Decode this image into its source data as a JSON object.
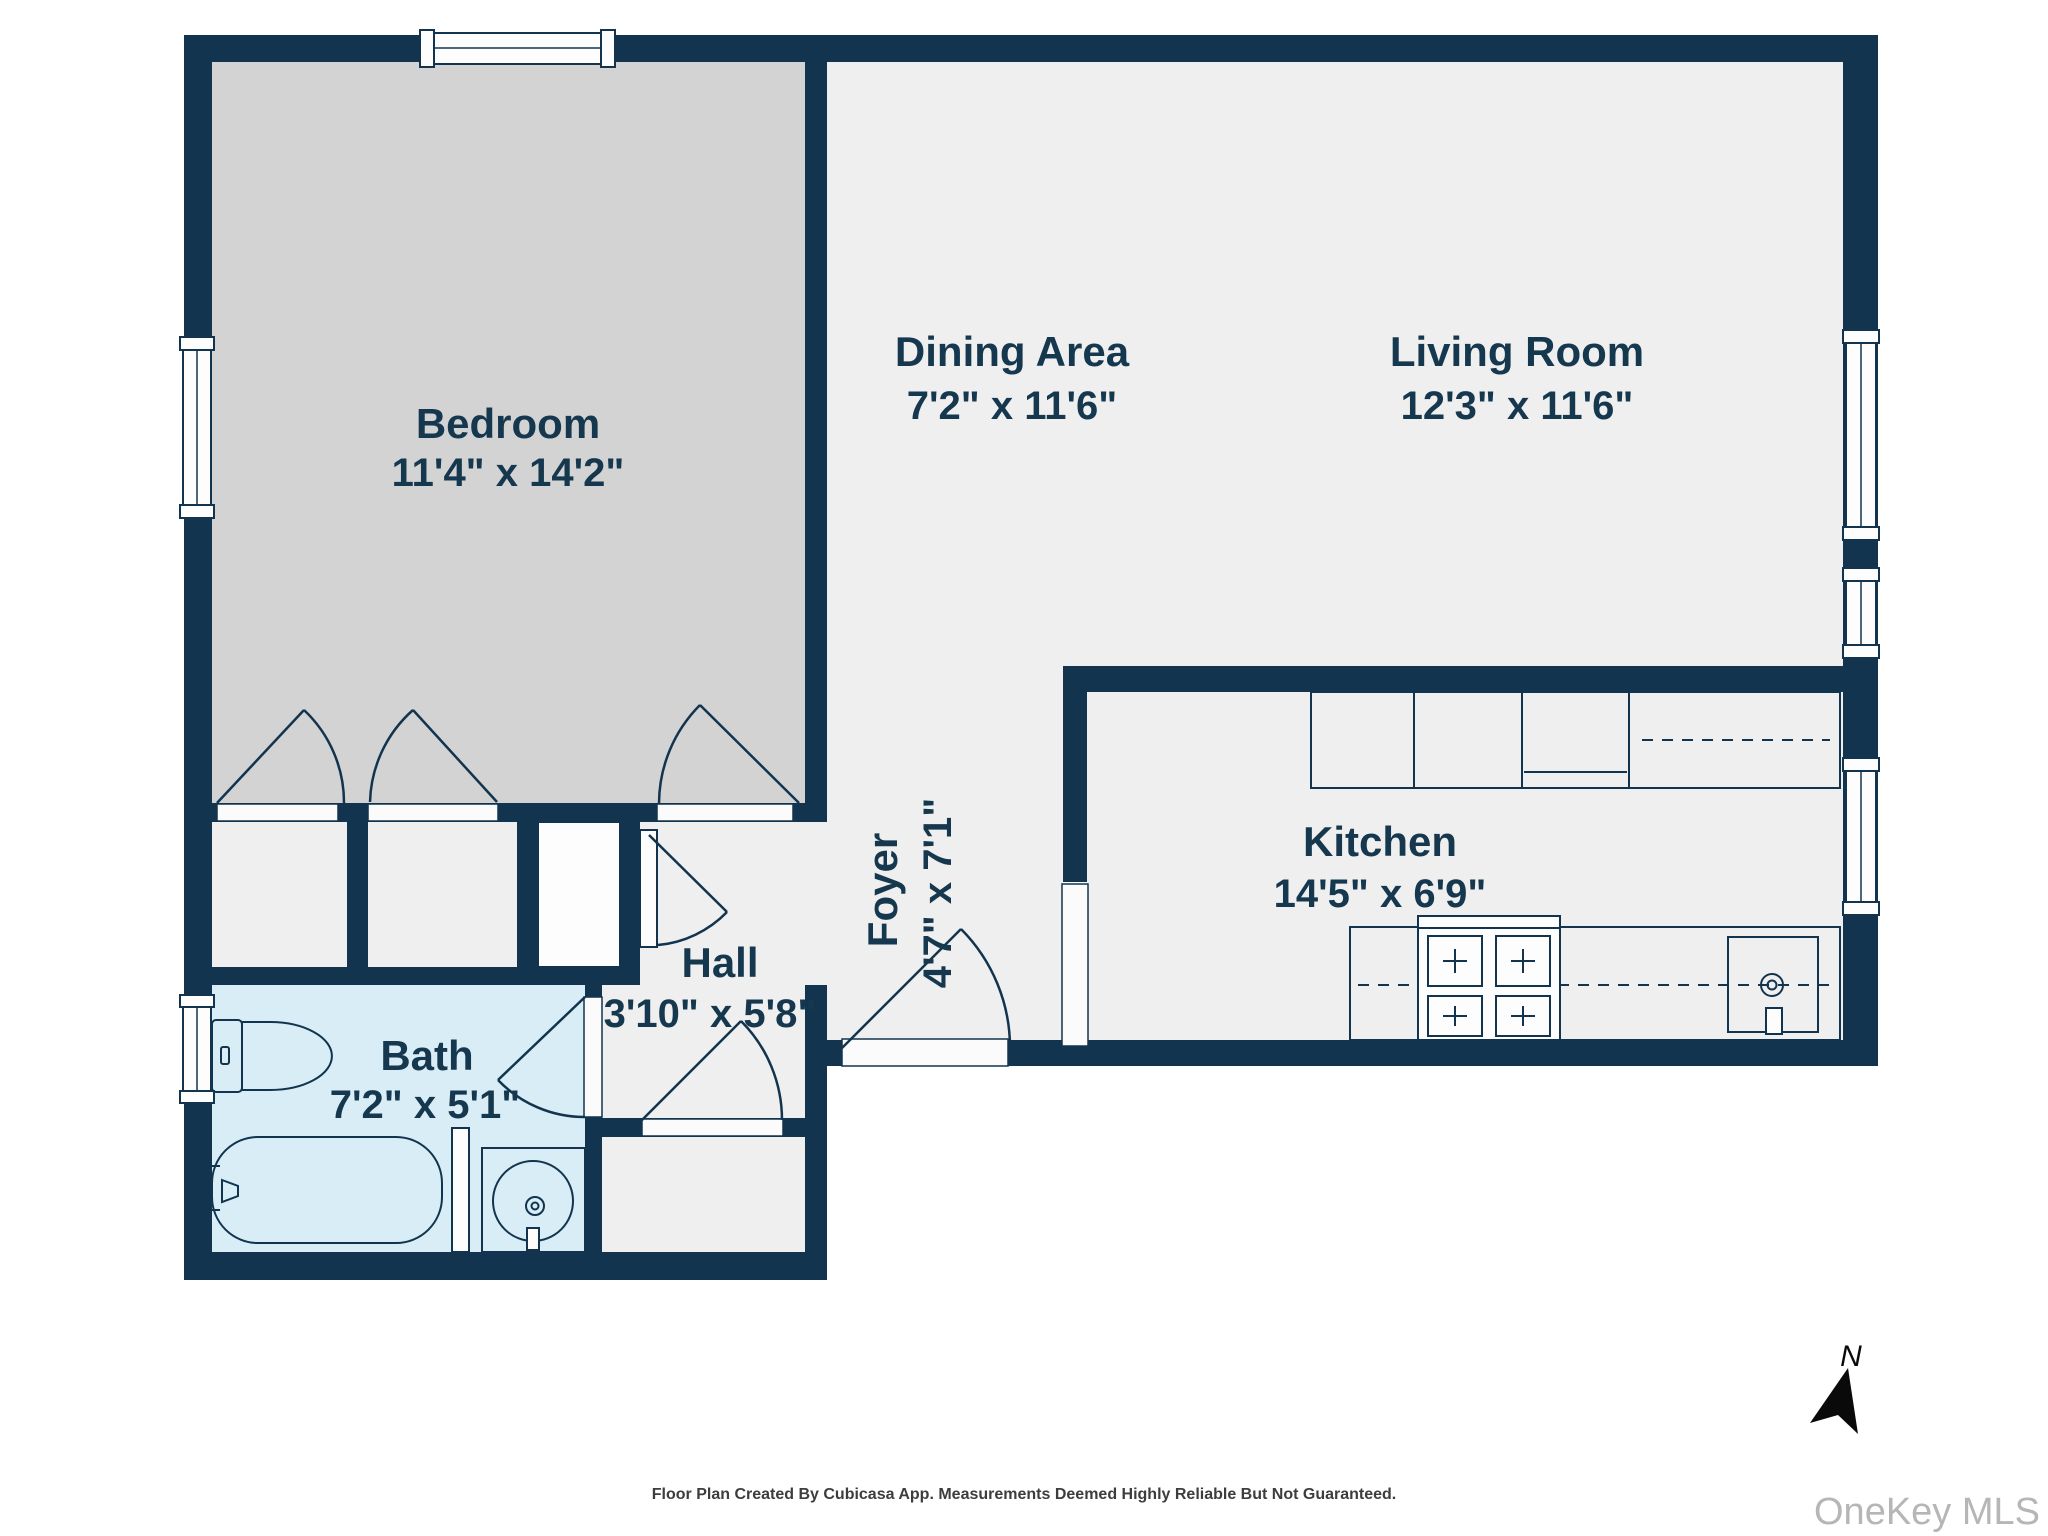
{
  "page": {
    "background": "#ffffff"
  },
  "colors": {
    "wall": "#12344e",
    "floor": "#efefef",
    "bedroom_floor": "#d3d3d3",
    "bath_floor": "#d9edf7",
    "label_text": "#16384f",
    "footer_text": "#3d3d3d",
    "watermark_text": "#b6b6b6",
    "north_arrow": "#0a0a0a"
  },
  "rooms": {
    "bedroom": {
      "name": "Bedroom",
      "dims": "11'4\" x 14'2\""
    },
    "dining": {
      "name": "Dining Area",
      "dims": "7'2\" x 11'6\""
    },
    "living": {
      "name": "Living Room",
      "dims": "12'3\" x 11'6\""
    },
    "kitchen": {
      "name": "Kitchen",
      "dims": "14'5\" x 6'9\""
    },
    "foyer": {
      "name": "Foyer",
      "dims": "4'7\" x 7'1\""
    },
    "hall": {
      "name": "Hall",
      "dims": "3'10\" x 5'8\""
    },
    "bath": {
      "name": "Bath",
      "dims": "7'2\" x 5'1\""
    }
  },
  "compass": {
    "label": "N"
  },
  "footer": {
    "text": "Floor Plan Created By Cubicasa App. Measurements Deemed Highly Reliable But Not Guaranteed."
  },
  "watermark": {
    "text": "OneKey MLS"
  }
}
